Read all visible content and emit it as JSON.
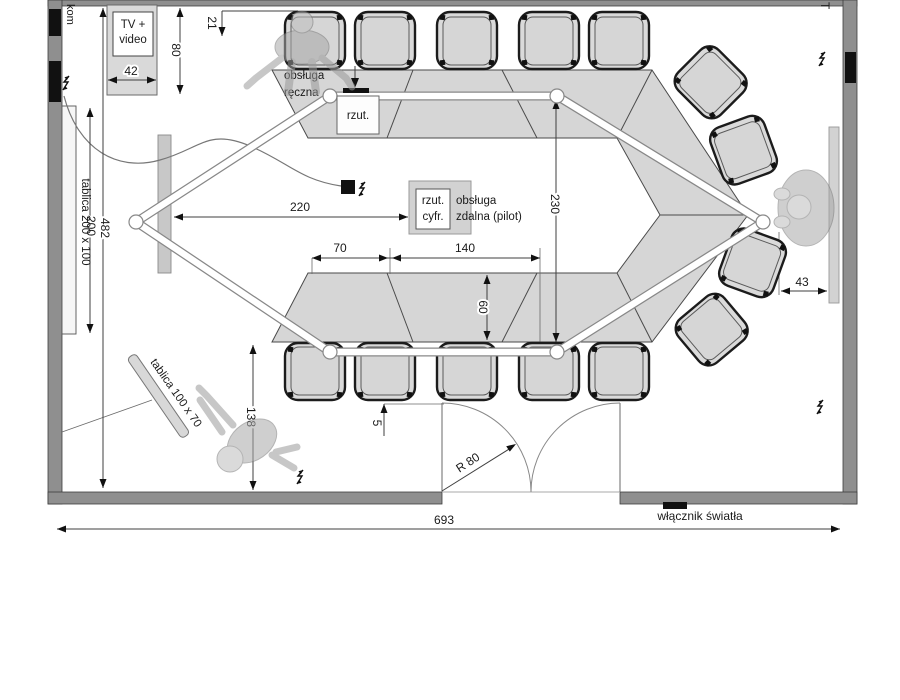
{
  "labels": {
    "kom": "kom",
    "t": "T",
    "tv_line1": "TV +",
    "tv_line2": "video",
    "obsluga_reczna_line1": "obsługa",
    "obsluga_reczna_line2": "ręczna",
    "rzut": "rzut.",
    "rzut_cyfr_line1": "rzut.",
    "rzut_cyfr_line2": "cyfr.",
    "obsluga_zdalna_line1": "obsługa",
    "obsluga_zdalna_line2": "zdalna (pilot)",
    "tablica_duza": "tablica 200 x 100",
    "tablica_mala": "tablica 100 x 70",
    "wlacznik": "włącznik światła",
    "r80": "R 80"
  },
  "dims": {
    "d21": "21",
    "d80": "80",
    "d42": "42",
    "d200": "200",
    "d482": "482",
    "d220": "220",
    "d230": "230",
    "d70": "70",
    "d140": "140",
    "d60": "60",
    "d138": "138",
    "d5": "5",
    "d43": "43",
    "d693": "693"
  },
  "colors": {
    "wall": "#8f8f8f",
    "table": "#d6d6d6",
    "chair": "#dadada",
    "screen": "#c8c8c8",
    "dimension_line": "#3f3f3f",
    "accent_black": "#111111"
  }
}
